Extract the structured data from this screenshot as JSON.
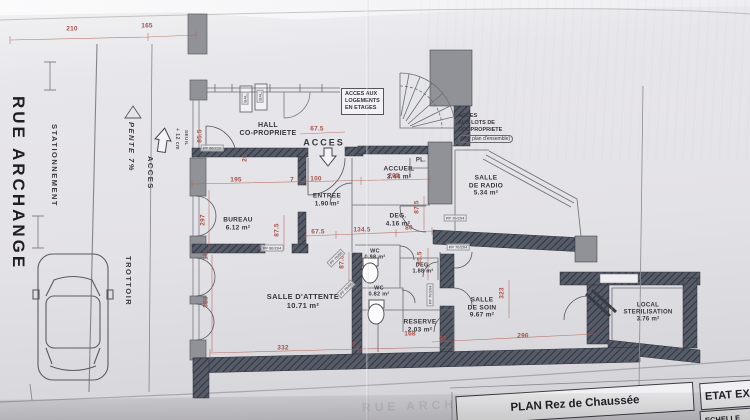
{
  "street": {
    "name": "RUE ARCHANGE",
    "parking": "STATIONNEMENT",
    "sidewalk": "TROTTOIR",
    "slope": "PENTE 7%",
    "access": "ACCES",
    "threshold_height": "+ 12 cm",
    "threshold": "SEUIL",
    "watermark": "RUE ARCHANGE"
  },
  "interior_access_label": "ACCES",
  "notes": [
    {
      "id": "acces-logements",
      "text": "ACCES AUX\nLOGEMENTS\nEN ETAGES",
      "sub": "",
      "x": 341,
      "y": 88,
      "boxed": true
    },
    {
      "id": "acces-lots",
      "text": "ACCES\nAUX LOTS DE\nCOOPROPRIETE",
      "sub": "(voir plan d'ensemble)",
      "x": 458,
      "y": 113,
      "boxed": false
    }
  ],
  "rooms": [
    {
      "id": "hall",
      "label": "HALL\nCO-PROPRIETE",
      "area": "",
      "x": 268,
      "y": 130,
      "fs": 7
    },
    {
      "id": "accueil",
      "label": "ACCUEIL",
      "area": "3.44 m²",
      "x": 399,
      "y": 173,
      "fs": 6.5
    },
    {
      "id": "placard",
      "label": "PL.",
      "area": "",
      "x": 421,
      "y": 161,
      "fs": 6
    },
    {
      "id": "radio",
      "label": "SALLE\nDE RADIO",
      "area": "5.34 m²",
      "x": 486,
      "y": 186,
      "fs": 6.5
    },
    {
      "id": "entree",
      "label": "ENTREE",
      "area": "1.90 m²",
      "x": 327,
      "y": 200,
      "fs": 6.5
    },
    {
      "id": "deg-1",
      "label": "DEG.",
      "area": "4.16 m²",
      "x": 398,
      "y": 220,
      "fs": 6.5
    },
    {
      "id": "bureau",
      "label": "BUREAU",
      "area": "6.12 m²",
      "x": 238,
      "y": 224,
      "fs": 6.5
    },
    {
      "id": "wc-1",
      "label": "WC",
      "area": "0.98 m²",
      "x": 375,
      "y": 255,
      "fs": 5.5
    },
    {
      "id": "deg-2",
      "label": "DEG.",
      "area": "1.88 m²",
      "x": 423,
      "y": 269,
      "fs": 5.5
    },
    {
      "id": "wc-2",
      "label": "WC",
      "area": "0.82 m²",
      "x": 379,
      "y": 292,
      "fs": 5.5
    },
    {
      "id": "attente",
      "label": "SALLE D'ATTENTE",
      "area": "10.71 m²",
      "x": 303,
      "y": 302,
      "fs": 7.5
    },
    {
      "id": "reserve",
      "label": "RESERVE",
      "area": "2.03 m²",
      "x": 420,
      "y": 326,
      "fs": 6.5
    },
    {
      "id": "soin",
      "label": "SALLE\nDE SOIN",
      "area": "9.67 m²",
      "x": 482,
      "y": 308,
      "fs": 6.5
    },
    {
      "id": "local",
      "label": "LOCAL\nSTERILISATION",
      "area": "3.76 m²",
      "x": 648,
      "y": 313,
      "fs": 6
    }
  ],
  "dimensions": [
    {
      "v": "210",
      "x": 72,
      "y": 29,
      "rot": 0
    },
    {
      "v": "165",
      "x": 147,
      "y": 26,
      "rot": 0
    },
    {
      "v": "85.5",
      "x": 200,
      "y": 136,
      "rot": 1
    },
    {
      "v": "20",
      "x": 245,
      "y": 158,
      "rot": 1
    },
    {
      "v": "67.5",
      "x": 317,
      "y": 129,
      "rot": 0
    },
    {
      "v": "195",
      "x": 236,
      "y": 180,
      "rot": 0
    },
    {
      "v": "7",
      "x": 292,
      "y": 180,
      "rot": 0
    },
    {
      "v": "100",
      "x": 316,
      "y": 179,
      "rot": 0
    },
    {
      "v": "205",
      "x": 394,
      "y": 176,
      "rot": 0
    },
    {
      "v": "297",
      "x": 203,
      "y": 220,
      "rot": 1
    },
    {
      "v": "87.5",
      "x": 277,
      "y": 230,
      "rot": 1
    },
    {
      "v": "67.5",
      "x": 318,
      "y": 232,
      "rot": 0
    },
    {
      "v": "134.5",
      "x": 362,
      "y": 230,
      "rot": 0
    },
    {
      "v": "80",
      "x": 409,
      "y": 228,
      "rot": 0
    },
    {
      "v": "87.5",
      "x": 417,
      "y": 207,
      "rot": 1
    },
    {
      "v": "15",
      "x": 206,
      "y": 256,
      "rot": 1
    },
    {
      "v": "87.5",
      "x": 342,
      "y": 262,
      "rot": 1
    },
    {
      "v": "85.5",
      "x": 420,
      "y": 258,
      "rot": 1
    },
    {
      "v": "323",
      "x": 206,
      "y": 302,
      "rot": 1
    },
    {
      "v": "332",
      "x": 283,
      "y": 348,
      "rot": 0
    },
    {
      "v": "7",
      "x": 354,
      "y": 345,
      "rot": 0
    },
    {
      "v": "168",
      "x": 410,
      "y": 334,
      "rot": 0
    },
    {
      "v": "323",
      "x": 502,
      "y": 293,
      "rot": 1
    },
    {
      "v": "61",
      "x": 443,
      "y": 339,
      "rot": 0
    },
    {
      "v": "296",
      "x": 523,
      "y": 336,
      "rot": 0
    }
  ],
  "door_labels": [
    {
      "v": "PP 80/210",
      "x": 212,
      "y": 148,
      "rot": 0
    },
    {
      "v": "PP 80/204",
      "x": 272,
      "y": 248,
      "rot": 0
    },
    {
      "v": "PP 70/204",
      "x": 455,
      "y": 218,
      "rot": 0
    },
    {
      "v": "PP 70/204",
      "x": 458,
      "y": 247,
      "rot": 0
    },
    {
      "v": "PF 70/95",
      "x": 336,
      "y": 258,
      "rot": -45
    },
    {
      "v": "PF 70/95",
      "x": 346,
      "y": 289,
      "rot": -45
    },
    {
      "v": "PP 70/204",
      "x": 430,
      "y": 295,
      "rot": 1
    },
    {
      "v": "BAL.",
      "x": 245,
      "y": 98,
      "rot": 1
    },
    {
      "v": "BAL.",
      "x": 260,
      "y": 96,
      "rot": 1
    }
  ],
  "title_block": {
    "plan_title": "PLAN Rez de Chaussée",
    "state_label": "ETAT EX",
    "scale_label": "ECHELLE"
  },
  "colors": {
    "dimension_red": "#a8524a",
    "wall_dark": "#4e5260",
    "pier_gray": "#909298",
    "paper": "#e3e2e6",
    "ink": "#36363c"
  }
}
